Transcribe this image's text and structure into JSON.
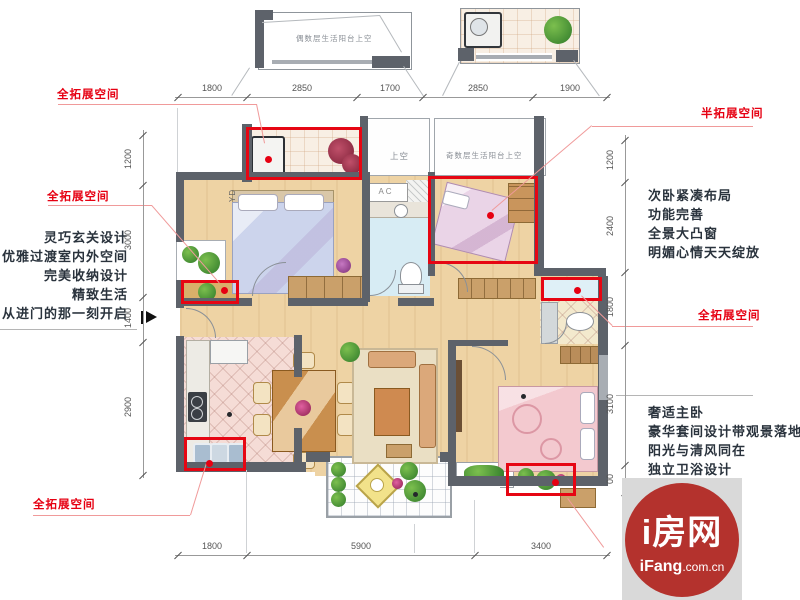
{
  "red_labels": {
    "top_left": "全拓展空间",
    "mid_left": "全拓展空间",
    "bottom_left": "全拓展空间",
    "top_right": "半拓展空间",
    "mid_right": "全拓展空间"
  },
  "feature_texts": {
    "entry": [
      "灵巧玄关设计",
      "优雅过渡室内外空间",
      "完美收纳设计",
      "精致生活",
      "从进门的那一刻开启"
    ],
    "second_bedroom": [
      "次卧紧凑布局",
      "功能完善",
      "全景大凸窗",
      "明媚心情天天绽放"
    ],
    "master_bedroom": [
      "奢适主卧",
      "豪华套间设计带观景落地窗",
      "阳光与清风同在",
      "独立卫浴设计"
    ]
  },
  "plan_labels": {
    "even_floor_balcony": "偶数层生活阳台上空",
    "odd_floor_balcony": "奇数层生活阳台上空",
    "void": "上空",
    "ac": "AC",
    "yd": "YD"
  },
  "dimensions": {
    "top": [
      "1800",
      "2850",
      "1700",
      "2850",
      "1900"
    ],
    "left": [
      "1200",
      "3000",
      "1400",
      "2900"
    ],
    "right": [
      "1200",
      "2400",
      "1800",
      "3100",
      "00"
    ],
    "bottom": [
      "1800",
      "5900",
      "3400"
    ]
  },
  "logo": {
    "brand": "i房网",
    "domain_bold": "iFang",
    "domain_suffix": ".com.cn"
  },
  "colors": {
    "accent_red": "#e60012",
    "leader_red": "#f09a9a",
    "wall": "#5d626a",
    "wood": "#eed3a4"
  }
}
